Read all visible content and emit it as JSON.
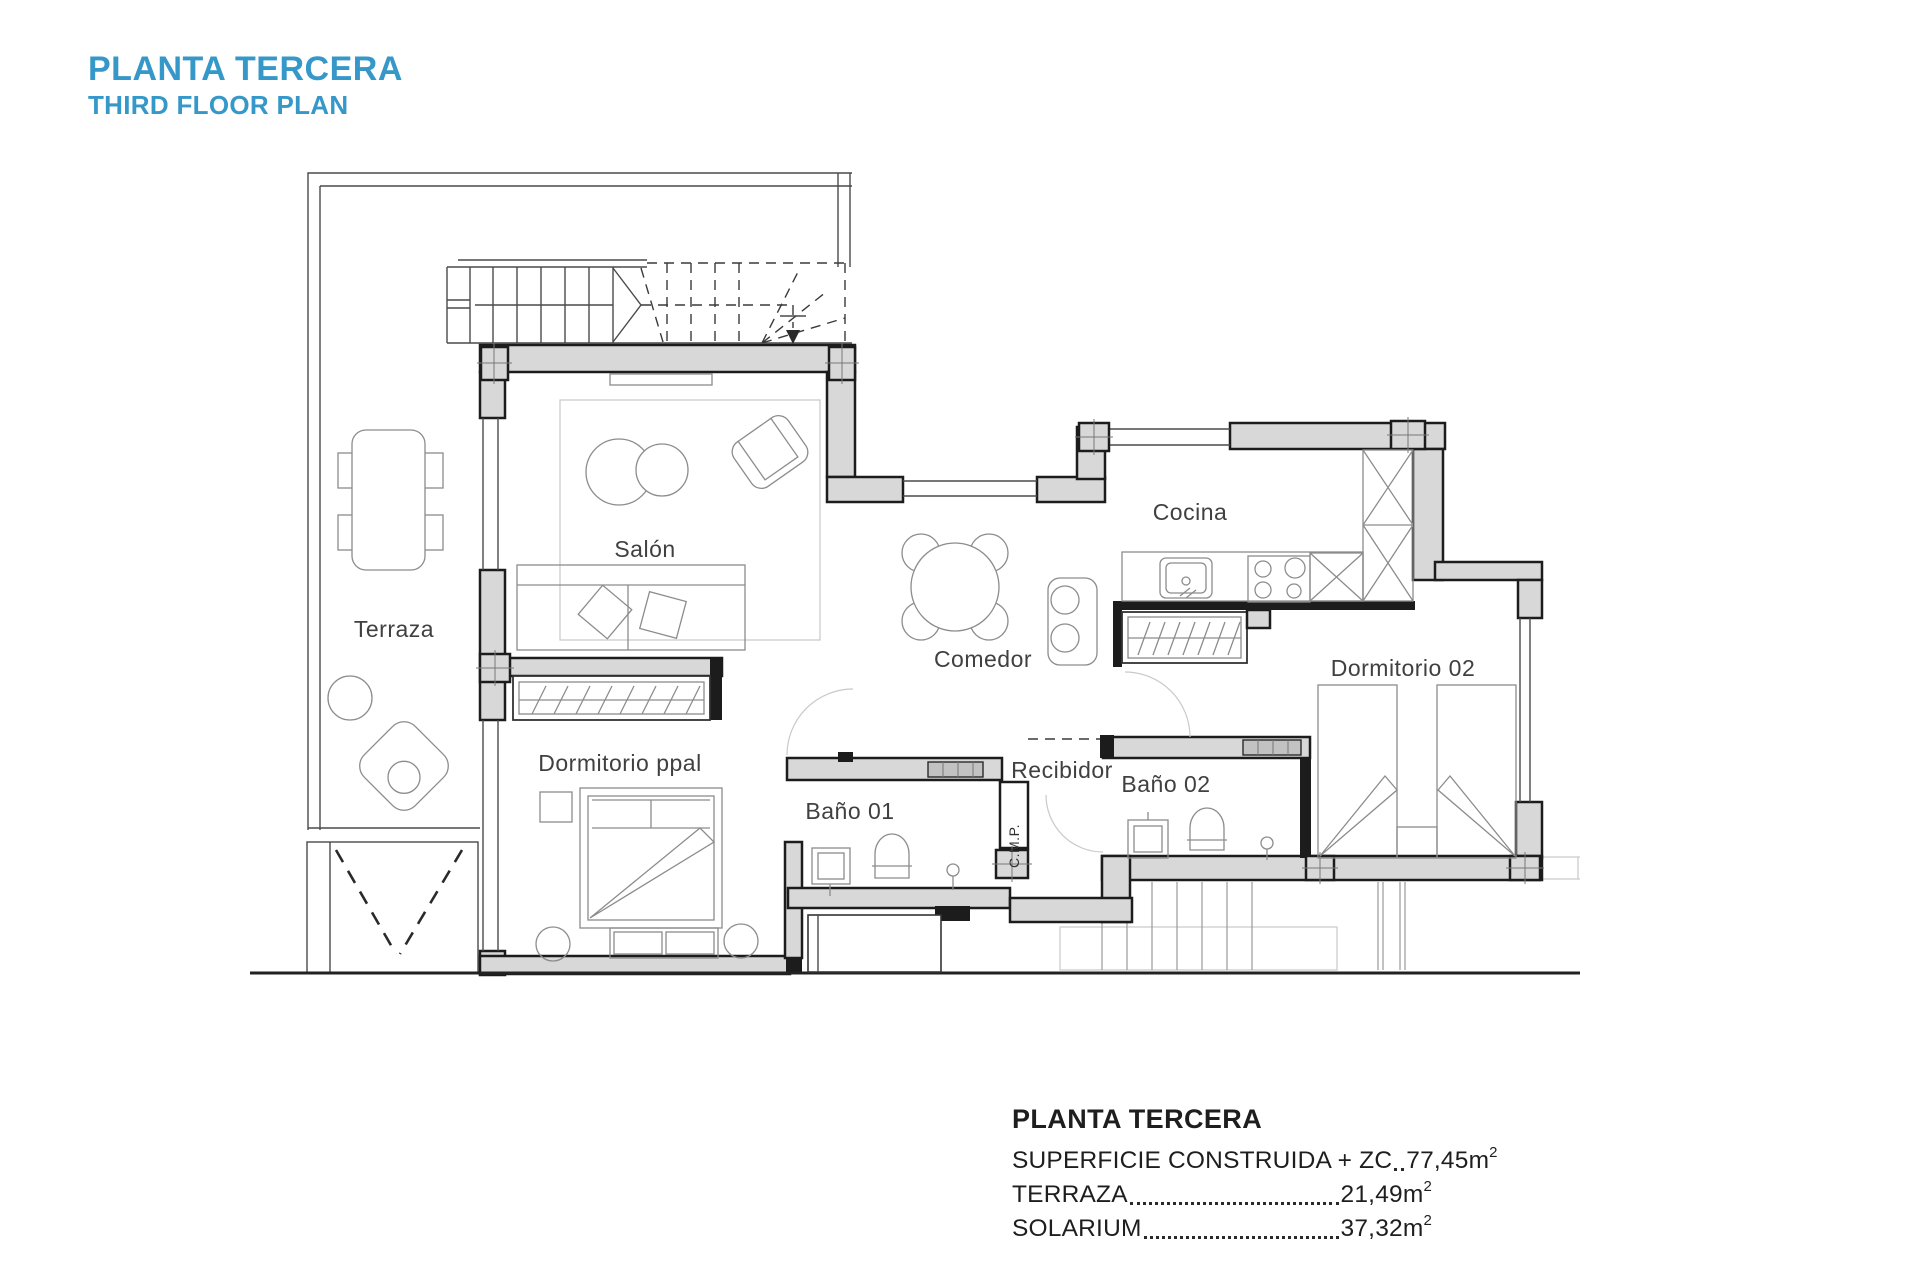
{
  "header": {
    "title_es": "PLANTA TERCERA",
    "title_en": "THIRD FLOOR PLAN"
  },
  "rooms": {
    "terraza": "Terraza",
    "salon": "Salón",
    "comedor": "Comedor",
    "cocina": "Cocina",
    "dormitorio02": "Dormitorio 02",
    "dormitorio_ppal": "Dormitorio ppal",
    "bano01": "Baño 01",
    "bano02": "Baño 02",
    "recibidor": "Recibidor",
    "cmp": "C.M.P."
  },
  "summary": {
    "title": "PLANTA TERCERA",
    "rows": [
      {
        "label": "SUPERFICIE CONSTRUIDA + ZC",
        "value": "77,45",
        "unit_base": "m",
        "unit_exp": "2"
      },
      {
        "label": "TERRAZA",
        "value": "21,49",
        "unit_base": "m",
        "unit_exp": "2"
      },
      {
        "label": "SOLARIUM",
        "value": "37,32",
        "unit_base": "m",
        "unit_exp": "2"
      }
    ]
  },
  "colors": {
    "accent": "#3598c8",
    "wall_fill": "#d8d8d8",
    "wall_stroke": "#1c1c1c",
    "furniture_line": "#8c8c8c"
  }
}
